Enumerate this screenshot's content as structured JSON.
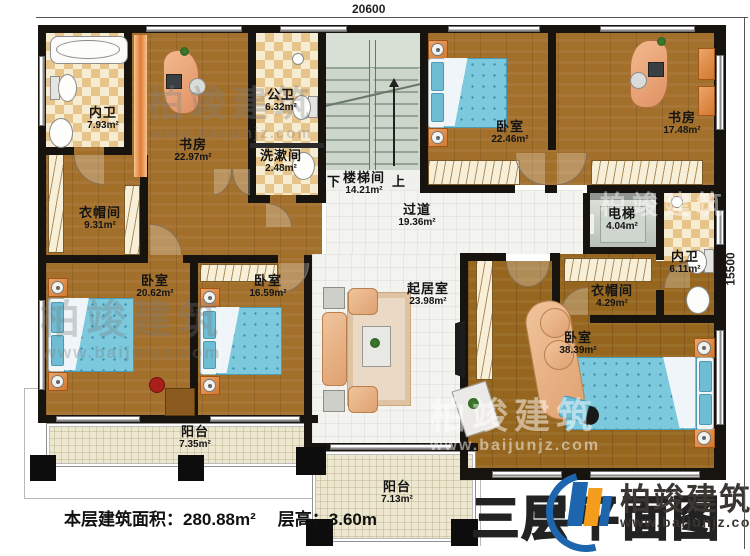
{
  "dimensions": {
    "top": "20600",
    "right": "15500"
  },
  "rooms": [
    {
      "id": "bath-top-left",
      "name": "内卫",
      "area": "7.93m²"
    },
    {
      "id": "study-left",
      "name": "书房",
      "area": "22.97m²"
    },
    {
      "id": "public-bath",
      "name": "公卫",
      "area": "6.32m²"
    },
    {
      "id": "washroom",
      "name": "洗漱间",
      "area": "2.48m²"
    },
    {
      "id": "stairwell",
      "name": "楼梯间",
      "area": "14.21m²"
    },
    {
      "id": "bedroom-top",
      "name": "卧室",
      "area": "22.46m²"
    },
    {
      "id": "study-right",
      "name": "书房",
      "area": "17.48m²"
    },
    {
      "id": "cloakroom-left",
      "name": "衣帽间",
      "area": "9.31m²"
    },
    {
      "id": "hallway",
      "name": "过道",
      "area": "19.36m²"
    },
    {
      "id": "elevator",
      "name": "电梯",
      "area": "4.04m²"
    },
    {
      "id": "bath-right",
      "name": "内卫",
      "area": "6.11m²"
    },
    {
      "id": "cloakroom-right",
      "name": "衣帽间",
      "area": "4.29m²"
    },
    {
      "id": "bedroom-left",
      "name": "卧室",
      "area": "20.62m²"
    },
    {
      "id": "bedroom-mid",
      "name": "卧室",
      "area": "16.59m²"
    },
    {
      "id": "living-room",
      "name": "起居室",
      "area": "23.98m²"
    },
    {
      "id": "master-bedroom",
      "name": "卧室",
      "area": "38.39m²"
    },
    {
      "id": "balcony-left",
      "name": "阳台",
      "area": "7.35m²"
    },
    {
      "id": "balcony-center",
      "name": "阳台",
      "area": "7.13m²"
    }
  ],
  "stairs": {
    "down": "下",
    "up": "上"
  },
  "footer": {
    "floor_area": "本层建筑面积：280.88m²",
    "floor_height": "层高：3.60m"
  },
  "title": {
    "plan_title": "三层平面图"
  },
  "logo": {
    "brand": "柏竣建筑",
    "website": "www.baijunjz.com"
  },
  "watermark": {
    "brand": "柏竣建筑",
    "website": "www.baijunjz.com"
  }
}
